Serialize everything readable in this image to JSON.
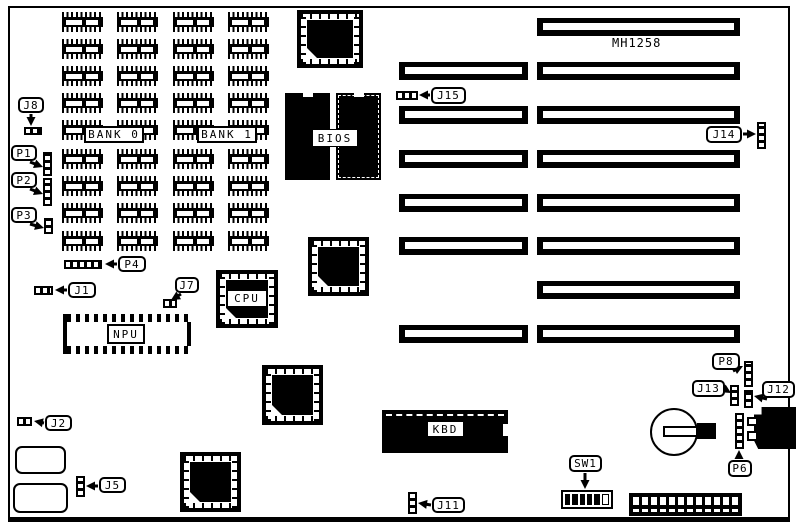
{
  "board": {
    "label": "MH1258",
    "label_x": 612,
    "label_y": 36
  },
  "ram": {
    "columns_x": [
      62,
      117,
      173,
      228
    ],
    "rows_y": [
      12,
      39,
      66,
      93,
      120,
      149,
      176,
      203,
      231
    ],
    "chip_w": 41,
    "chip_h": 20,
    "banks": [
      {
        "label": "BANK 0",
        "x": 84,
        "y": 126,
        "w": 60,
        "h": 17
      },
      {
        "label": "BANK 1",
        "x": 197,
        "y": 126,
        "w": 60,
        "h": 17
      }
    ]
  },
  "slots": {
    "short": {
      "x": 399,
      "w": 129,
      "h": 18,
      "ys": [
        62,
        106,
        150,
        194,
        237,
        325
      ]
    },
    "long": {
      "x": 537,
      "w": 203,
      "h": 18,
      "ys": [
        18,
        62,
        106,
        150,
        194,
        237,
        281,
        325
      ]
    }
  },
  "plcc": [
    {
      "name": "plcc-socket-top",
      "x": 297,
      "y": 10,
      "w": 66,
      "h": 58,
      "label": ""
    },
    {
      "name": "cpu-socket",
      "x": 216,
      "y": 270,
      "w": 62,
      "h": 58,
      "label": "CPU"
    },
    {
      "name": "plcc-socket-middle",
      "x": 308,
      "y": 237,
      "w": 61,
      "h": 59,
      "label": ""
    },
    {
      "name": "plcc-socket-lower",
      "x": 262,
      "y": 365,
      "w": 61,
      "h": 60,
      "label": ""
    },
    {
      "name": "plcc-socket-bottom",
      "x": 180,
      "y": 452,
      "w": 61,
      "h": 60,
      "label": ""
    }
  ],
  "bios": {
    "label": "BIOS",
    "left": {
      "x": 285,
      "y": 93,
      "w": 45,
      "h": 87
    },
    "right": {
      "x": 336,
      "y": 93,
      "w": 45,
      "h": 87
    },
    "label_box": {
      "x": 312,
      "y": 129,
      "w": 46,
      "h": 18
    }
  },
  "npu": {
    "label": "NPU",
    "x": 63,
    "y": 314,
    "w": 128,
    "h": 40,
    "label_box": {
      "x": 107,
      "y": 324,
      "w": 38,
      "h": 20
    }
  },
  "kbd": {
    "label": "KBD",
    "x": 382,
    "y": 410,
    "w": 126,
    "h": 43,
    "label_box": {
      "x": 427,
      "y": 421,
      "w": 37,
      "h": 16
    }
  },
  "jumpers": [
    {
      "id": "J8-header",
      "dir": "h",
      "x": 24,
      "y": 127,
      "w": 18,
      "h": 8
    },
    {
      "id": "P1-header",
      "dir": "v",
      "x": 43,
      "y": 152,
      "w": 9,
      "h": 24
    },
    {
      "id": "P2-header",
      "dir": "v",
      "x": 43,
      "y": 178,
      "w": 9,
      "h": 28
    },
    {
      "id": "P3-header",
      "dir": "v",
      "x": 44,
      "y": 218,
      "w": 9,
      "h": 16
    },
    {
      "id": "P4-header",
      "dir": "h",
      "x": 64,
      "y": 260,
      "w": 38,
      "h": 9
    },
    {
      "id": "J1-header",
      "dir": "h",
      "x": 34,
      "y": 286,
      "w": 19,
      "h": 9
    },
    {
      "id": "J7-header",
      "dir": "h",
      "x": 163,
      "y": 299,
      "w": 14,
      "h": 9
    },
    {
      "id": "J2-header",
      "dir": "h",
      "x": 17,
      "y": 417,
      "w": 15,
      "h": 9
    },
    {
      "id": "J5-header",
      "dir": "v",
      "x": 76,
      "y": 476,
      "w": 9,
      "h": 21
    },
    {
      "id": "J11-header",
      "dir": "v",
      "x": 408,
      "y": 492,
      "w": 9,
      "h": 22
    },
    {
      "id": "J15-header",
      "dir": "h",
      "x": 396,
      "y": 91,
      "w": 22,
      "h": 9
    },
    {
      "id": "J14-header",
      "dir": "v",
      "x": 757,
      "y": 122,
      "w": 9,
      "h": 27
    },
    {
      "id": "P8-header",
      "dir": "v",
      "x": 744,
      "y": 361,
      "w": 9,
      "h": 26
    },
    {
      "id": "J13-header",
      "dir": "v",
      "x": 730,
      "y": 385,
      "w": 9,
      "h": 21
    },
    {
      "id": "J12-header",
      "dir": "v",
      "x": 744,
      "y": 390,
      "w": 9,
      "h": 18
    },
    {
      "id": "P6-header",
      "dir": "v",
      "x": 735,
      "y": 413,
      "w": 9,
      "h": 36
    }
  ],
  "callouts": [
    {
      "label": "J8",
      "x": 18,
      "y": 97,
      "w": 26,
      "h": 16,
      "tail": [
        31,
        114,
        31,
        126
      ]
    },
    {
      "label": "P1",
      "x": 11,
      "y": 145,
      "w": 26,
      "h": 16,
      "tail": [
        30,
        162,
        43,
        167
      ]
    },
    {
      "label": "P2",
      "x": 11,
      "y": 172,
      "w": 26,
      "h": 16,
      "tail": [
        30,
        189,
        43,
        194
      ]
    },
    {
      "label": "P3",
      "x": 11,
      "y": 207,
      "w": 26,
      "h": 16,
      "tail": [
        30,
        224,
        44,
        228
      ]
    },
    {
      "label": "P4",
      "x": 118,
      "y": 256,
      "w": 28,
      "h": 16,
      "tail": [
        117,
        264,
        105,
        264
      ]
    },
    {
      "label": "J1",
      "x": 68,
      "y": 282,
      "w": 28,
      "h": 16,
      "tail": [
        67,
        290,
        55,
        290
      ]
    },
    {
      "label": "J7",
      "x": 175,
      "y": 277,
      "w": 24,
      "h": 16,
      "tail": [
        181,
        294,
        171,
        300
      ]
    },
    {
      "label": "J2",
      "x": 45,
      "y": 415,
      "w": 27,
      "h": 16,
      "tail": [
        44,
        423,
        34,
        421
      ]
    },
    {
      "label": "J5",
      "x": 99,
      "y": 477,
      "w": 27,
      "h": 16,
      "tail": [
        98,
        486,
        86,
        486
      ]
    },
    {
      "label": "J11",
      "x": 432,
      "y": 497,
      "w": 33,
      "h": 16,
      "tail": [
        431,
        505,
        418,
        503
      ]
    },
    {
      "label": "J15",
      "x": 431,
      "y": 87,
      "w": 35,
      "h": 17,
      "tail": [
        430,
        95,
        419,
        95
      ]
    },
    {
      "label": "J14",
      "x": 706,
      "y": 126,
      "w": 36,
      "h": 17,
      "tail": [
        743,
        134,
        756,
        134
      ]
    },
    {
      "label": "P8",
      "x": 712,
      "y": 353,
      "w": 28,
      "h": 17,
      "tail": [
        733,
        371,
        743,
        366
      ]
    },
    {
      "label": "J13",
      "x": 692,
      "y": 380,
      "w": 33,
      "h": 17,
      "tail": [
        726,
        390,
        731,
        393
      ]
    },
    {
      "label": "J12",
      "x": 762,
      "y": 381,
      "w": 33,
      "h": 17,
      "tail": [
        767,
        399,
        754,
        396
      ]
    },
    {
      "label": "P6",
      "x": 728,
      "y": 460,
      "w": 24,
      "h": 17,
      "tail": [
        739,
        459,
        739,
        450
      ]
    },
    {
      "label": "SW1",
      "x": 569,
      "y": 455,
      "w": 33,
      "h": 17,
      "tail": [
        585,
        473,
        585,
        489
      ]
    }
  ],
  "sw1": {
    "x": 561,
    "y": 490,
    "w": 52,
    "h": 19,
    "cells": [
      1,
      1,
      1,
      1,
      1,
      0
    ]
  },
  "battery": {
    "x": 650,
    "y": 408,
    "d": 48,
    "tab_white": [
      663,
      426,
      35,
      11
    ],
    "tab_black": [
      697,
      423,
      19,
      16
    ]
  },
  "crystals": [
    {
      "x": 15,
      "y": 446,
      "w": 51,
      "h": 28
    },
    {
      "x": 13,
      "y": 483,
      "w": 55,
      "h": 30
    }
  ],
  "power_connector": {
    "x": 629,
    "y": 493,
    "w": 113,
    "h": 23
  },
  "din_connector": {
    "x": 754,
    "y": 407,
    "w": 42,
    "h": 42,
    "tabs": [
      [
        747,
        417,
        11,
        9
      ],
      [
        747,
        431,
        11,
        10
      ]
    ]
  }
}
